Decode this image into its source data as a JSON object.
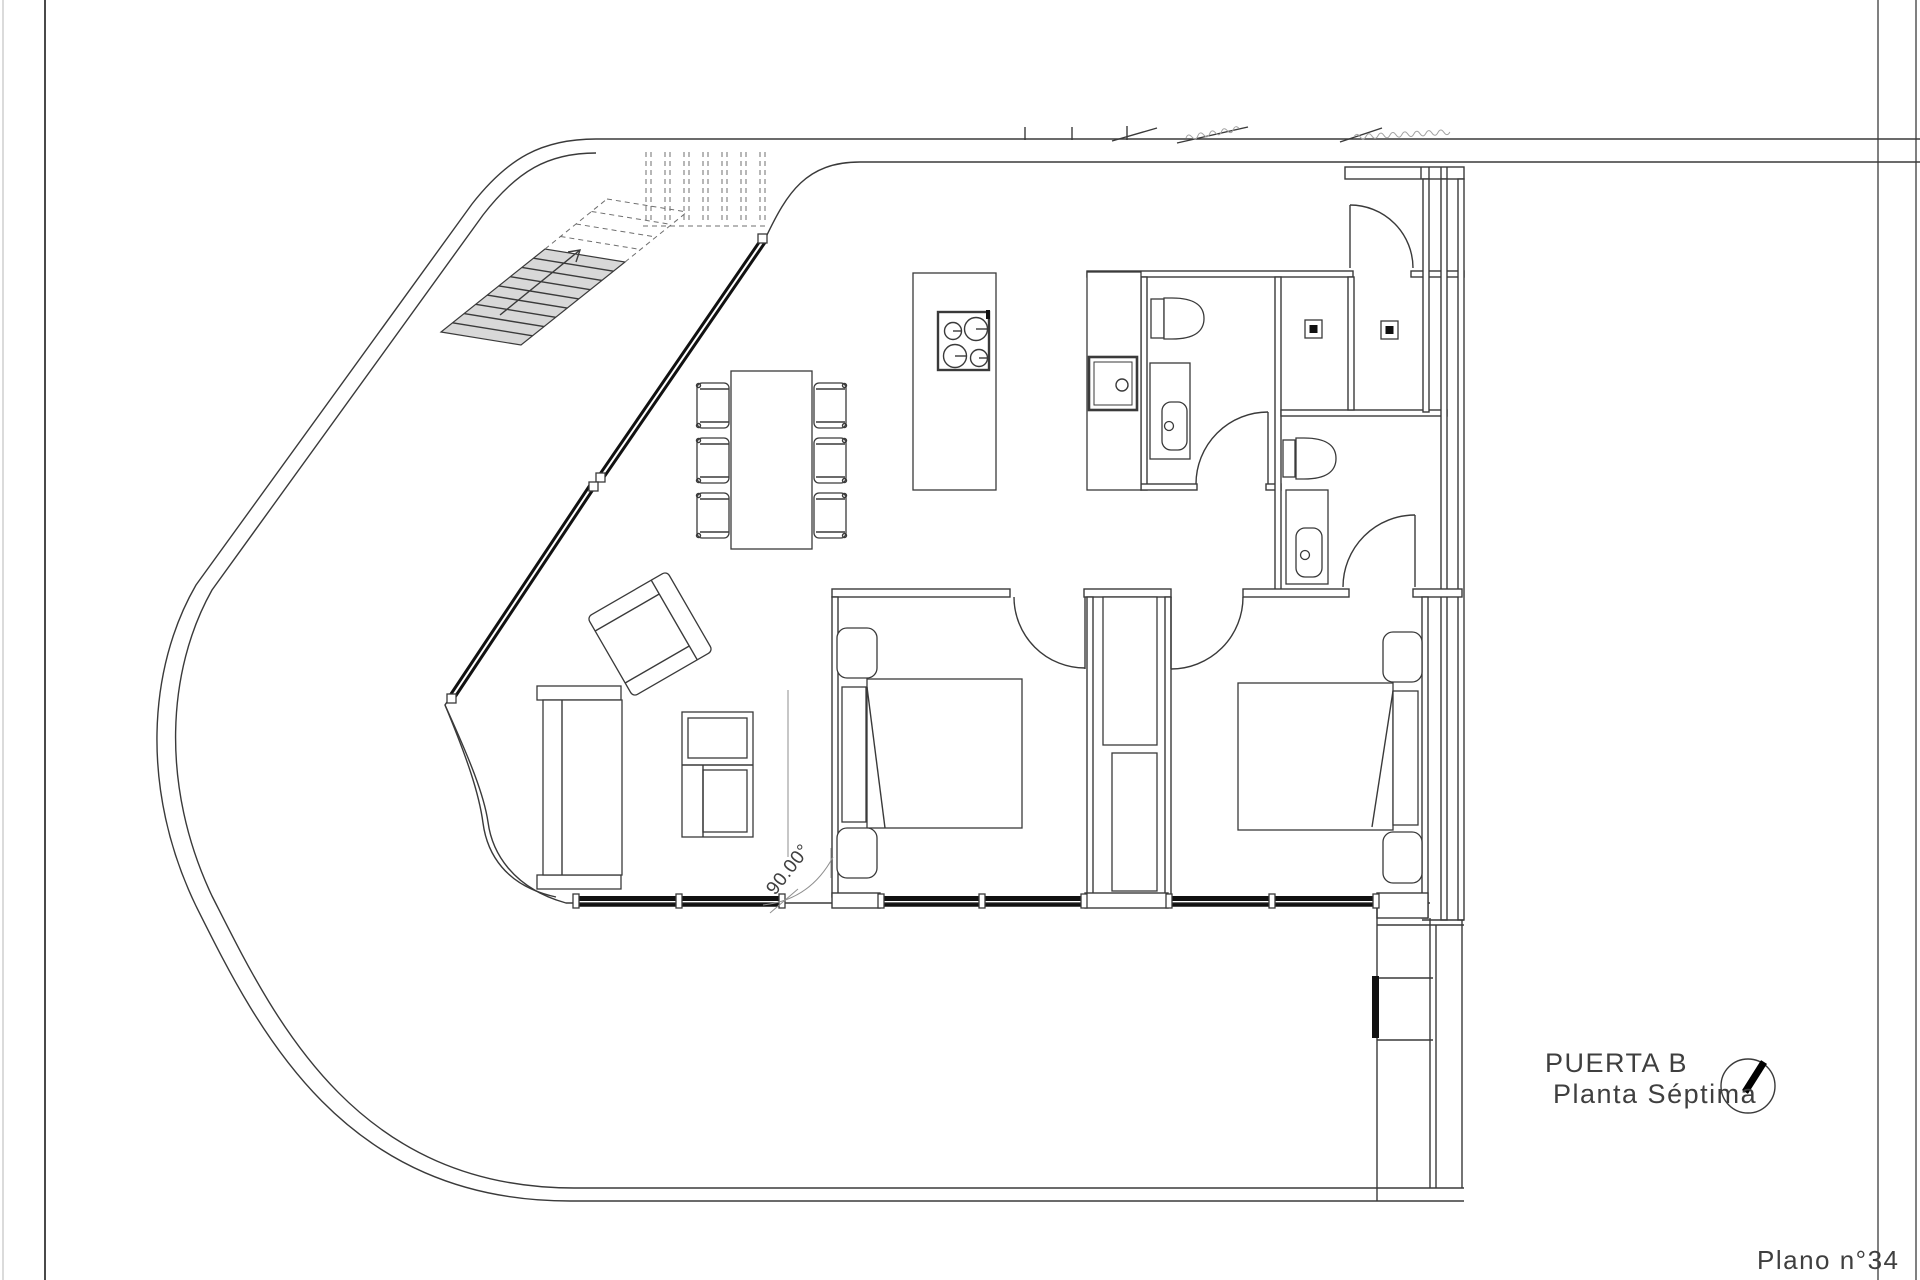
{
  "labels": {
    "door": "PUERTA B",
    "floor": "Planta Séptima",
    "plan_number": "Plano n°34",
    "angle": "90.00°"
  },
  "colors": {
    "line": "#3a3a3a",
    "light_line": "#8f8f8f",
    "stair_fill": "#d8d8d8",
    "glazing": "#111111",
    "background": "#ffffff",
    "text": "#3f3f3f"
  }
}
